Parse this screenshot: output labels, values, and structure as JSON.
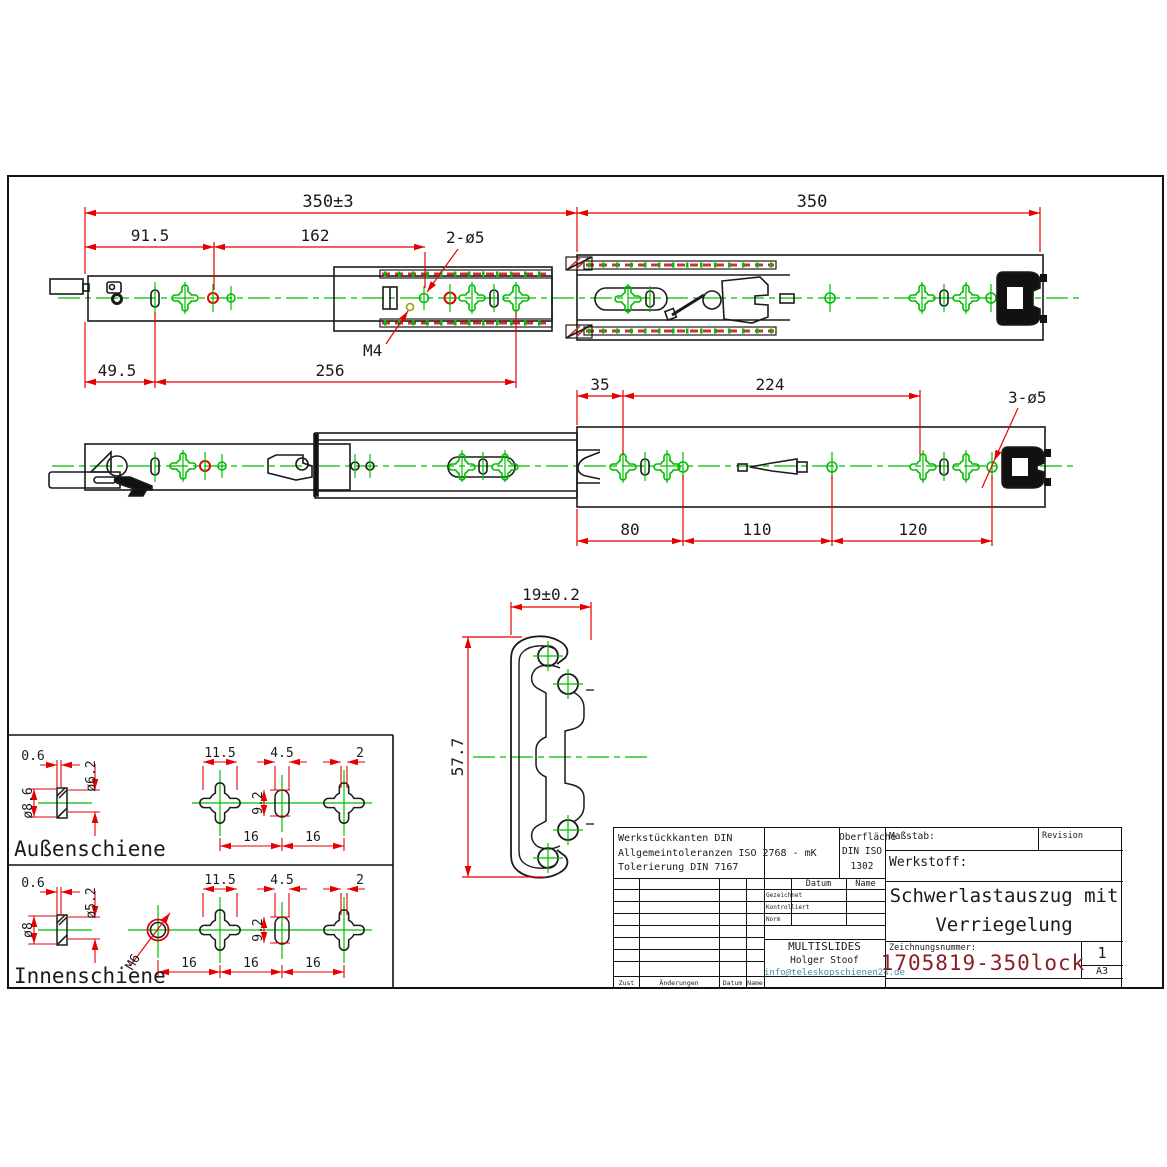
{
  "dims": {
    "top_view": {
      "overall": "350±3",
      "overall_right": "350",
      "front": "91.5",
      "mid": "162",
      "holes": "2-ø5",
      "thread": "M4",
      "front_lower": "49.5",
      "mid_lower": "256"
    },
    "side_view": {
      "first": "35",
      "span": "224",
      "holes": "3-ø5",
      "p1": "80",
      "p2": "110",
      "p3": "120"
    },
    "section": {
      "width": "19±0.2",
      "height": "57.7"
    },
    "outer_rail": {
      "label": "Außenschiene",
      "lip": "0.6",
      "bore": "ø6.2",
      "flange": "ø8.6",
      "clover_w": "11.5",
      "slot_w": "4.5",
      "notch": "2",
      "slot_h": "9.2",
      "pitch1": "16",
      "pitch2": "16"
    },
    "inner_rail": {
      "label": "Innenschiene",
      "lip": "0.6",
      "bore": "ø5.2",
      "flange": "ø8",
      "thread": "M6",
      "clover_w": "11.5",
      "slot_w": "4.5",
      "notch": "2",
      "slot_h": "9.2",
      "pitch1": "16",
      "pitch2": "16",
      "pitch3": "16"
    }
  },
  "titleblock": {
    "tolerance_line1": "Werkstückkanten DIN",
    "tolerance_line2": "Allgemeintoleranzen ISO 2768 - mK",
    "tolerance_line3": "Tolerierung DIN 7167",
    "surface_line1": "Oberfläche",
    "surface_line2": "DIN ISO",
    "surface_line3": "1302",
    "scale_label": "Maßstab:",
    "revision_label": "Revision",
    "material_label": "Werkstoff:",
    "date_col": "Datum",
    "name_col": "Name",
    "row_drawn": "Gezeichnet",
    "row_checked": "Kontrolliert",
    "row_standard": "Norm",
    "company": "MULTISLIDES",
    "author": "Holger Stoof",
    "email": "info@teleskopschienen24.de",
    "drawing_no_label": "Zeichnungsnummer:",
    "drawing_no": "1705819-350lock",
    "title_line1": "Schwerlastauszug mit",
    "title_line2": "Verriegelung",
    "sheet_no": "1",
    "paper": "A3",
    "rev_zust": "Zust",
    "rev_aenderungen": "Änderungen",
    "rev_datum": "Datum",
    "rev_name": "Name"
  },
  "colors": {
    "dimension_red": "#e60000",
    "centerline_green": "#00bd00",
    "label_maroon": "#8b2b2b",
    "drawing_no_red": "#8b1e28",
    "email_teal": "#3f8ea5"
  }
}
